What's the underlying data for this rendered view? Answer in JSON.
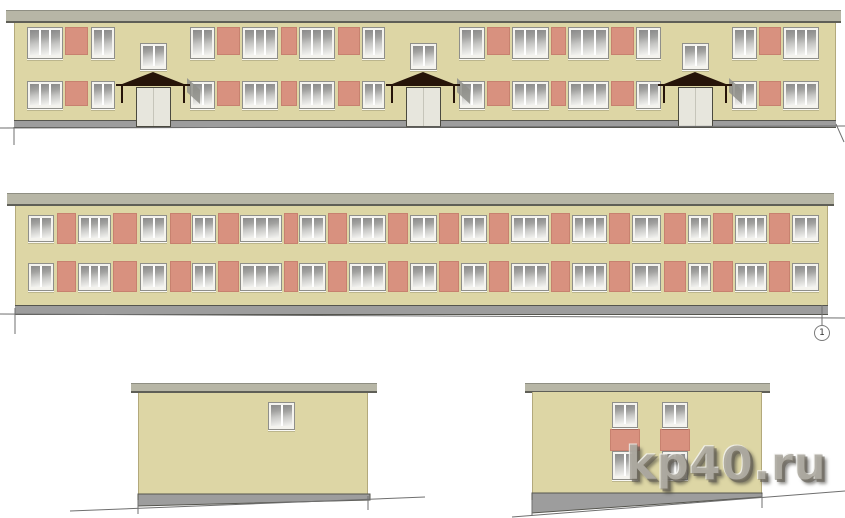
{
  "watermark": {
    "text": "kp40.ru"
  },
  "axis_marker": {
    "label": "1",
    "x": 822,
    "y": 333,
    "r": 8
  },
  "colors": {
    "wall": "#ddd6a5",
    "wall_edge": "#b3a97c",
    "parapet": "#b7b6a6",
    "parapet_top": "#8f8f83",
    "parapet_bottom": "#5f5f57",
    "panel": "#d8917f",
    "window_frame": "#f4f3ee",
    "window_border": "#8f8f8a",
    "glass_top": "#8a8a8a",
    "glass_mid": "#c6c6c4",
    "glass_bottom": "#f5f5f2",
    "plinth": "#9d9d9d",
    "plinth_edge": "#55554e",
    "door": "#e7e6dd",
    "door_edge": "#4a493f",
    "canopy": "#261409",
    "shadow": "#8f8f89",
    "line": "#6f6f6f"
  },
  "elevations": [
    {
      "id": "front-elevation",
      "parapet": {
        "x": 6,
        "y": 10,
        "w": 835,
        "h": 13
      },
      "wall": {
        "x": 14,
        "y": 23,
        "w": 822,
        "h": 97
      },
      "plinth": {
        "x": 14,
        "y": 120,
        "w": 822,
        "h": 8
      },
      "windows": [
        [
          27,
          27,
          36,
          32,
          3
        ],
        [
          91,
          27,
          24,
          32,
          2
        ],
        [
          190,
          27,
          25,
          32,
          2
        ],
        [
          242,
          27,
          36,
          32,
          3
        ],
        [
          299,
          27,
          36,
          32,
          3
        ],
        [
          362,
          27,
          23,
          32,
          2
        ],
        [
          459,
          27,
          26,
          32,
          2
        ],
        [
          512,
          27,
          37,
          32,
          3
        ],
        [
          568,
          27,
          41,
          32,
          3
        ],
        [
          636,
          27,
          25,
          32,
          2
        ],
        [
          732,
          27,
          25,
          32,
          2
        ],
        [
          783,
          27,
          36,
          32,
          3
        ],
        [
          140,
          43,
          27,
          27,
          2,
          "stair-window"
        ],
        [
          410,
          43,
          27,
          27,
          2,
          "stair-window"
        ],
        [
          682,
          43,
          27,
          27,
          2,
          "stair-window"
        ],
        [
          27,
          81,
          36,
          28,
          3
        ],
        [
          91,
          81,
          24,
          28,
          2
        ],
        [
          190,
          81,
          25,
          28,
          2
        ],
        [
          242,
          81,
          36,
          28,
          3
        ],
        [
          299,
          81,
          36,
          28,
          3
        ],
        [
          362,
          81,
          23,
          28,
          2
        ],
        [
          459,
          81,
          26,
          28,
          2
        ],
        [
          512,
          81,
          37,
          28,
          3
        ],
        [
          568,
          81,
          41,
          28,
          3
        ],
        [
          636,
          81,
          25,
          28,
          2
        ],
        [
          732,
          81,
          25,
          28,
          2
        ],
        [
          783,
          81,
          36,
          28,
          3
        ]
      ],
      "panels": [
        [
          65,
          27,
          23,
          28
        ],
        [
          217,
          27,
          23,
          28
        ],
        [
          281,
          27,
          16,
          28
        ],
        [
          338,
          27,
          22,
          28
        ],
        [
          487,
          27,
          23,
          28
        ],
        [
          551,
          27,
          15,
          28
        ],
        [
          611,
          27,
          23,
          28
        ],
        [
          759,
          27,
          22,
          28
        ],
        [
          65,
          81,
          23,
          25
        ],
        [
          217,
          81,
          23,
          25
        ],
        [
          281,
          81,
          16,
          25
        ],
        [
          338,
          81,
          22,
          25
        ],
        [
          487,
          81,
          23,
          25
        ],
        [
          551,
          81,
          15,
          25
        ],
        [
          611,
          81,
          23,
          25
        ],
        [
          759,
          81,
          22,
          25
        ]
      ],
      "doors": [
        [
          136,
          87,
          35,
          40
        ],
        [
          406,
          87,
          35,
          40
        ],
        [
          678,
          87,
          35,
          40
        ]
      ],
      "canopies": [
        [
          117,
          72,
          72,
          14
        ],
        [
          387,
          72,
          72,
          14
        ],
        [
          659,
          72,
          72,
          14
        ]
      ]
    },
    {
      "id": "rear-elevation",
      "parapet": {
        "x": 7,
        "y": 193,
        "w": 827,
        "h": 13
      },
      "wall": {
        "x": 15,
        "y": 206,
        "w": 813,
        "h": 99
      },
      "plinth": {
        "x": 15,
        "y": 305,
        "w": 813,
        "h": 10
      },
      "windows": [
        [
          28,
          215,
          26,
          27,
          2
        ],
        [
          78,
          215,
          33,
          27,
          3
        ],
        [
          140,
          215,
          27,
          27,
          2
        ],
        [
          192,
          215,
          24,
          27,
          2
        ],
        [
          240,
          215,
          42,
          27,
          3
        ],
        [
          299,
          215,
          27,
          27,
          2
        ],
        [
          349,
          215,
          37,
          27,
          3
        ],
        [
          410,
          215,
          27,
          27,
          2
        ],
        [
          461,
          215,
          26,
          27,
          2
        ],
        [
          511,
          215,
          38,
          27,
          3
        ],
        [
          572,
          215,
          35,
          27,
          3
        ],
        [
          632,
          215,
          29,
          27,
          2
        ],
        [
          688,
          215,
          23,
          27,
          2
        ],
        [
          735,
          215,
          32,
          27,
          3
        ],
        [
          792,
          215,
          27,
          27,
          2
        ],
        [
          28,
          263,
          26,
          28,
          2
        ],
        [
          78,
          263,
          33,
          28,
          3
        ],
        [
          140,
          263,
          27,
          28,
          2
        ],
        [
          192,
          263,
          24,
          28,
          2
        ],
        [
          240,
          263,
          42,
          28,
          3
        ],
        [
          299,
          263,
          27,
          28,
          2
        ],
        [
          349,
          263,
          37,
          28,
          3
        ],
        [
          410,
          263,
          27,
          28,
          2
        ],
        [
          461,
          263,
          26,
          28,
          2
        ],
        [
          511,
          263,
          38,
          28,
          3
        ],
        [
          572,
          263,
          35,
          28,
          3
        ],
        [
          632,
          263,
          29,
          28,
          2
        ],
        [
          688,
          263,
          23,
          28,
          2
        ],
        [
          735,
          263,
          32,
          28,
          3
        ],
        [
          792,
          263,
          27,
          28,
          2
        ]
      ],
      "panels": [
        [
          57,
          213,
          19,
          31
        ],
        [
          113,
          213,
          24,
          31
        ],
        [
          170,
          213,
          21,
          31
        ],
        [
          218,
          213,
          21,
          31
        ],
        [
          284,
          213,
          14,
          31
        ],
        [
          328,
          213,
          19,
          31
        ],
        [
          388,
          213,
          20,
          31
        ],
        [
          439,
          213,
          20,
          31
        ],
        [
          489,
          213,
          20,
          31
        ],
        [
          551,
          213,
          19,
          31
        ],
        [
          609,
          213,
          21,
          31
        ],
        [
          664,
          213,
          22,
          31
        ],
        [
          713,
          213,
          20,
          31
        ],
        [
          769,
          213,
          21,
          31
        ],
        [
          57,
          261,
          19,
          31
        ],
        [
          113,
          261,
          24,
          31
        ],
        [
          170,
          261,
          21,
          31
        ],
        [
          218,
          261,
          21,
          31
        ],
        [
          284,
          261,
          14,
          31
        ],
        [
          328,
          261,
          19,
          31
        ],
        [
          388,
          261,
          20,
          31
        ],
        [
          439,
          261,
          20,
          31
        ],
        [
          489,
          261,
          20,
          31
        ],
        [
          551,
          261,
          19,
          31
        ],
        [
          609,
          261,
          21,
          31
        ],
        [
          664,
          261,
          22,
          31
        ],
        [
          713,
          261,
          20,
          31
        ],
        [
          769,
          261,
          21,
          31
        ]
      ]
    },
    {
      "id": "left-gable-elevation",
      "parapet": {
        "x": 131,
        "y": 383,
        "w": 246,
        "h": 10
      },
      "wall": {
        "x": 138,
        "y": 393,
        "w": 230,
        "h": 101
      },
      "plinth_poly": "138,494 370,494 370,500 138,506",
      "windows": [
        [
          268,
          402,
          27,
          28,
          2
        ]
      ]
    },
    {
      "id": "right-gable-elevation",
      "parapet": {
        "x": 525,
        "y": 383,
        "w": 245,
        "h": 10
      },
      "wall": {
        "x": 532,
        "y": 392,
        "w": 230,
        "h": 101
      },
      "plinth_poly": "532,493 762,493 762,497 532,513",
      "windows": [
        [
          612,
          402,
          26,
          26,
          2
        ],
        [
          662,
          402,
          26,
          26,
          2
        ],
        [
          612,
          451,
          26,
          29,
          2
        ],
        [
          662,
          451,
          26,
          29,
          2
        ]
      ],
      "panels": [
        [
          610,
          429,
          30,
          22
        ],
        [
          660,
          429,
          30,
          22
        ]
      ]
    }
  ],
  "ground_lines": [
    [
      0,
      128,
      845,
      126
    ],
    [
      14,
      127,
      14,
      145
    ],
    [
      836,
      124,
      844,
      142
    ],
    [
      0,
      314,
      845,
      318
    ],
    [
      15,
      308,
      15,
      334
    ],
    [
      822,
      305,
      822,
      325
    ],
    [
      70,
      511,
      425,
      497
    ],
    [
      138,
      500,
      138,
      514
    ],
    [
      368,
      496,
      368,
      510
    ],
    [
      512,
      517,
      845,
      491
    ],
    [
      532,
      500,
      532,
      516
    ],
    [
      762,
      494,
      762,
      508
    ]
  ]
}
